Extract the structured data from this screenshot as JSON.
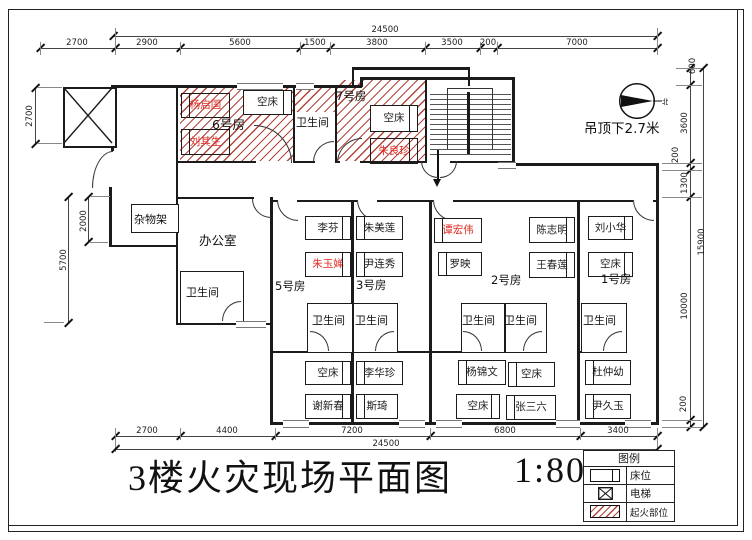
{
  "title": {
    "text": "3楼火灾现场平面图",
    "scale": "1:80"
  },
  "labels": {
    "bathroom": "卫生间",
    "office": "办公室",
    "shelf": "杂物架",
    "ceiling_note": "吊顶下2.7米",
    "north": "北"
  },
  "rooms": {
    "room1": "1号房",
    "room2": "2号房",
    "room3": "3号房",
    "room5": "5号房",
    "room6": "6号房",
    "room7": "7号房"
  },
  "beds": {
    "room6": [
      "杨启国",
      "空床",
      "刘其生"
    ],
    "room7": [
      "空床",
      "朱良珍"
    ],
    "room5": [
      "李芬",
      "朱玉婵",
      "空床",
      "谢新春"
    ],
    "room3": [
      "朱美莲",
      "尹连秀",
      "李华珍",
      "斯琦"
    ],
    "room2": [
      "谭宏伟",
      "罗映",
      "陈志明",
      "王春莲",
      "杨锦文",
      "空床",
      "空床",
      "张三六"
    ],
    "room1": [
      "刘小华",
      "空床",
      "杜仲幼",
      "尹久玉"
    ]
  },
  "victims": [
    "杨启国",
    "刘其生",
    "朱良珍",
    "朱玉婵",
    "谭宏伟"
  ],
  "legend": {
    "title": "图例",
    "bed": "床位",
    "elevator": "电梯",
    "fire_origin": "起火部位"
  },
  "dimensions": {
    "top_total": "24500",
    "top_chain": [
      "2700",
      "2900",
      "5600",
      "1500",
      "3800",
      "3500",
      "200",
      "7000"
    ],
    "bottom_chain": [
      "2700",
      "4400",
      "7200",
      "6800",
      "3400"
    ],
    "bottom_total": "24500",
    "left_chain": [
      "2700",
      "2000",
      "5700"
    ],
    "right_chain": [
      "600",
      "3600",
      "200",
      "1300",
      "10000",
      "200"
    ],
    "right_total": "15900"
  },
  "colors": {
    "fire_hatch": "#b0453c",
    "victim_name": "#e02a20",
    "wall": "#1b1b1b"
  }
}
